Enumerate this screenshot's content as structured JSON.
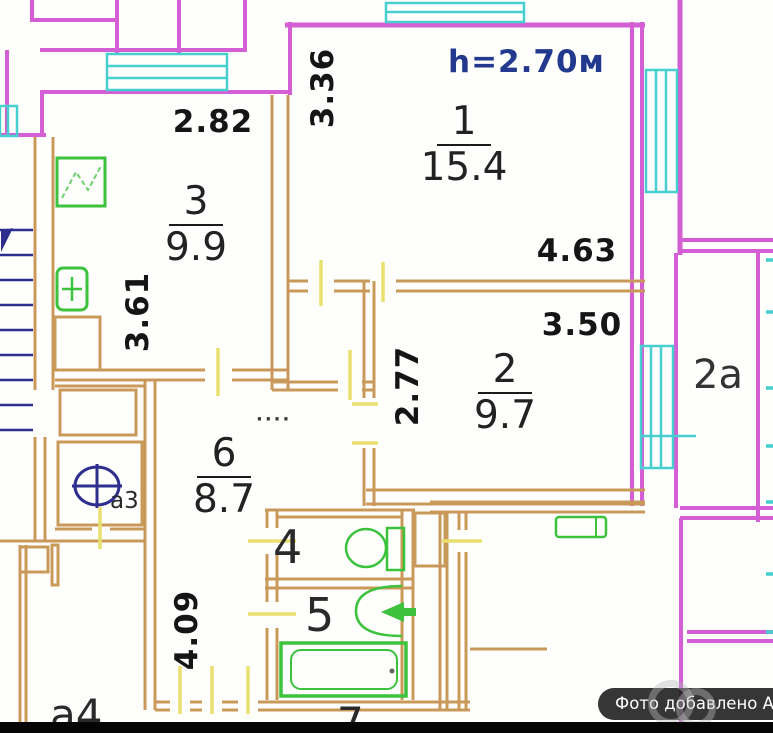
{
  "plan": {
    "ceiling_height_label": "h=2.70м",
    "rooms": {
      "r1": {
        "number": "1",
        "area": "15.4"
      },
      "r2": {
        "number": "2",
        "area": "9.7"
      },
      "r3": {
        "number": "3",
        "area": "9.9"
      },
      "r6": {
        "number": "6",
        "area": "8.7"
      },
      "r4": {
        "number": "4"
      },
      "r5": {
        "number": "5"
      },
      "r7": {
        "number": "7"
      },
      "r2a": {
        "number": "2а"
      },
      "ra3": {
        "number": "а3"
      },
      "ra4": {
        "number": "а4"
      }
    },
    "dimensions": {
      "d282": "2.82",
      "d336": "3.36",
      "d361": "3.61",
      "d463": "4.63",
      "d350": "3.50",
      "d277": "2.77",
      "d409": "4.09"
    },
    "dots": "····",
    "colors": {
      "outer_walls": "#d45fd4",
      "inner_walls": "#c9995a",
      "windows": "#45cfcf",
      "fixtures": "#3cc23c",
      "symbols": "#2e2e8f",
      "door_marks": "#e9e16e"
    }
  },
  "watermark": {
    "label": "Фото добавлено Авито"
  }
}
